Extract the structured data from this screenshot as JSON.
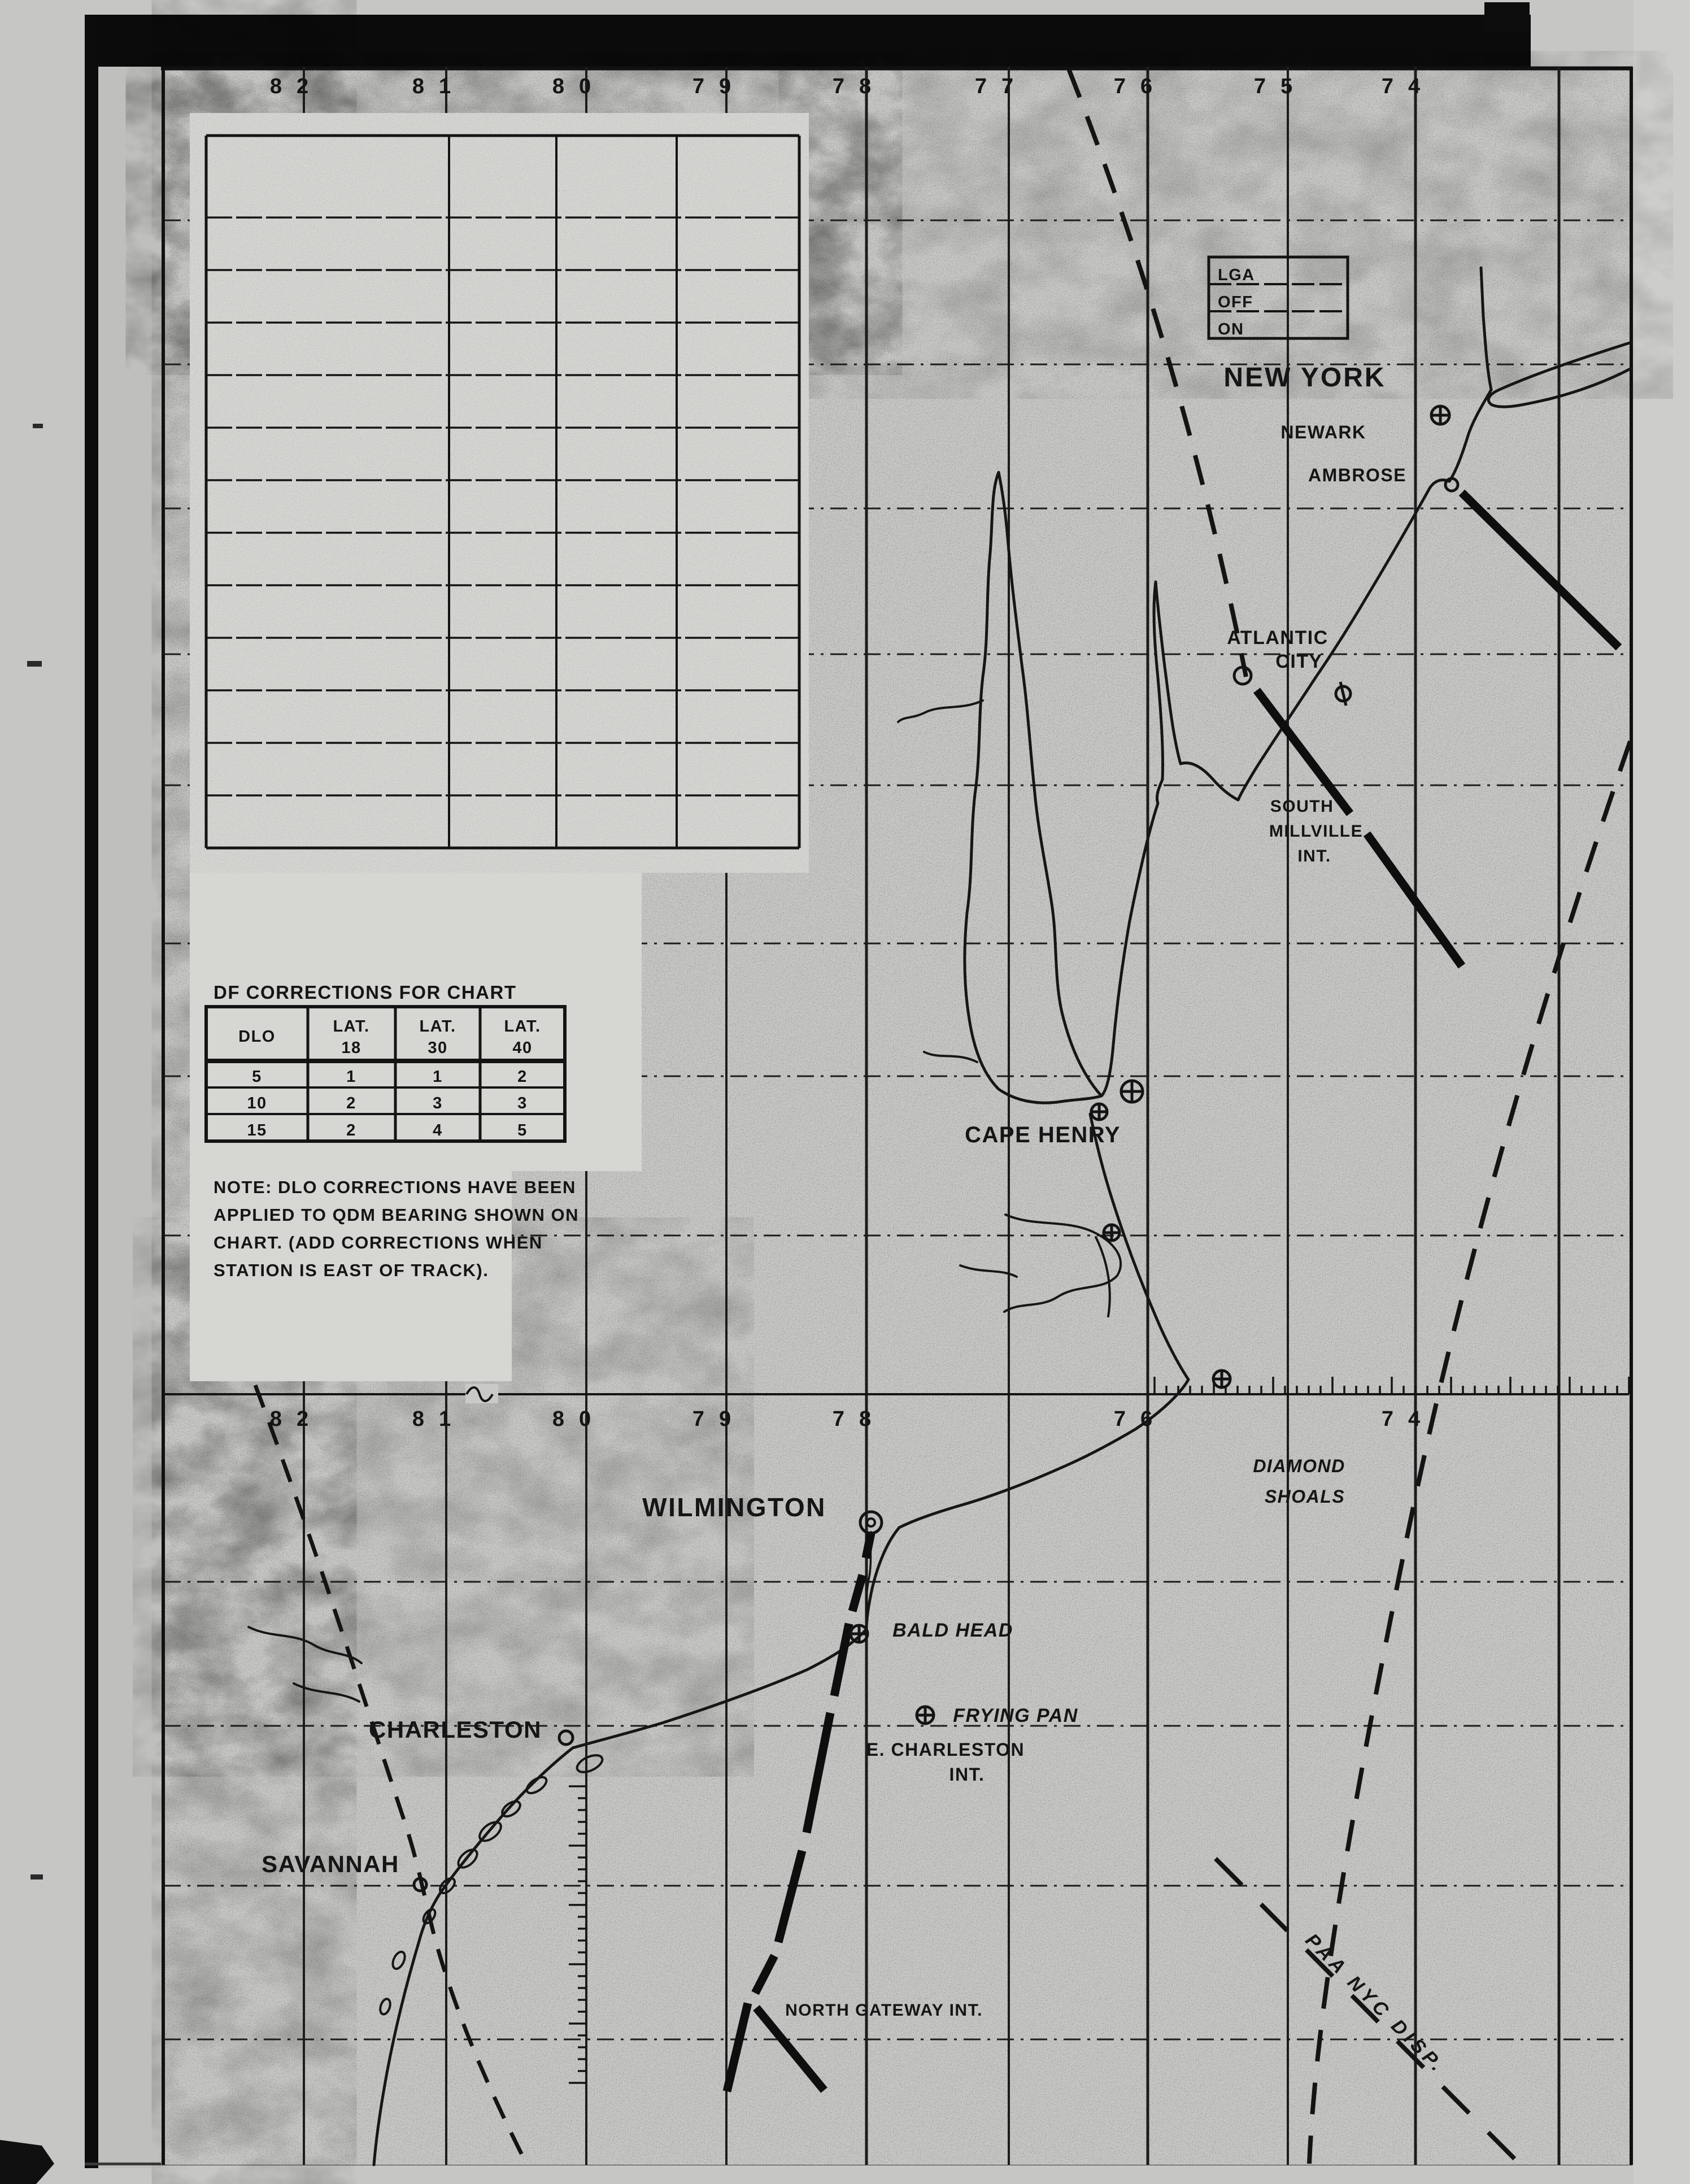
{
  "colors": {
    "ink": "#151515",
    "paper": "#c8c8c6",
    "patch": "#d7d7d4",
    "film_black": "#0a0a0a"
  },
  "top_longitude_labels": [
    "82",
    "81",
    "80",
    "79",
    "78",
    "77",
    "76",
    "75",
    "74"
  ],
  "mid_longitude_labels": [
    "82",
    "81",
    "80",
    "79",
    "78",
    "76",
    "74"
  ],
  "legend_box": {
    "rows": [
      "LGA",
      "OFF",
      "ON"
    ]
  },
  "df_table": {
    "title": "DF CORRECTIONS FOR CHART",
    "col1_header": "DLO",
    "lat_headers": [
      {
        "top": "LAT.",
        "bottom": "18"
      },
      {
        "top": "LAT.",
        "bottom": "30"
      },
      {
        "top": "LAT.",
        "bottom": "40"
      }
    ],
    "rows": [
      [
        "5",
        "1",
        "1",
        "2"
      ],
      [
        "10",
        "2",
        "3",
        "3"
      ],
      [
        "15",
        "2",
        "4",
        "5"
      ]
    ]
  },
  "note_lines": [
    "NOTE: DLO CORRECTIONS HAVE BEEN",
    "APPLIED TO QDM BEARING SHOWN ON",
    "CHART. (ADD CORRECTIONS WHEN",
    "STATION IS EAST OF TRACK)."
  ],
  "places": {
    "new_york": "NEW YORK",
    "newark": "NEWARK",
    "ambrose": "AMBROSE",
    "atlantic_city_line1": "ATLANTIC",
    "atlantic_city_line2": "CITY",
    "south_millville_line1": "SOUTH",
    "south_millville_line2": "MILLVILLE",
    "south_millville_line3": "INT.",
    "cape_henry": "CAPE HENRY",
    "diamond_shoals_line1": "DIAMOND",
    "diamond_shoals_line2": "SHOALS",
    "wilmington": "WILMINGTON",
    "bald_head": "BALD HEAD",
    "frying_pan": "FRYING PAN",
    "e_charleston_line1": "E. CHARLESTON",
    "e_charleston_line2": "INT.",
    "charleston": "CHARLESTON",
    "savannah": "SAVANNAH",
    "north_gateway": "NORTH GATEWAY INT.",
    "paa_route": "PAA NYC  DISP."
  }
}
